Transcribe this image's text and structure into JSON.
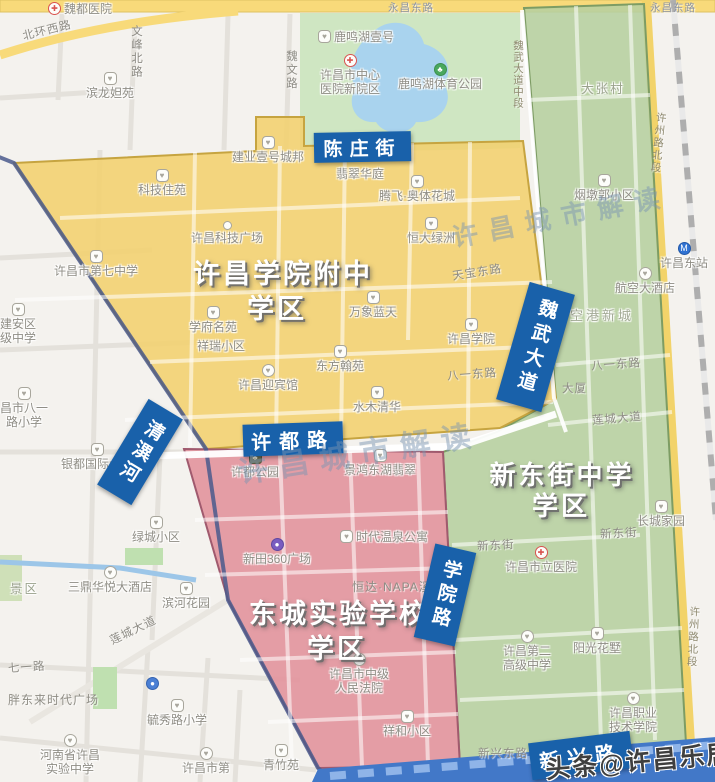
{
  "map_overlay": {
    "district_titles": {
      "yellow_1": "许昌学院附中",
      "yellow_2": "学区",
      "red_1": "东城实验学校",
      "red_2": "学区",
      "green_1": "新东街中学",
      "green_2": "学区"
    },
    "street_signs": {
      "chenzhuang": "陈庄街",
      "weiwu": "魏武大道",
      "xudu": "许都路",
      "qingyi": "清潩河",
      "xueyuan": "学院路",
      "xinxing": "新兴路"
    },
    "watermarks": {
      "city_1": "许昌城市解读",
      "city_2": "许昌城市解读",
      "credit": "头条@许昌乐居"
    }
  },
  "roads": {
    "yongchang_w": "永昌东路",
    "yongchang_e": "永昌东路",
    "beihuan_xi": "北环西路",
    "wenfeng_bei": "文峰北路",
    "weiwen": "魏文路",
    "weiwu_mid": "魏武大道中段",
    "tianbao_dong": "天宝东路",
    "bayi_dong_1": "八一东路",
    "bayi_dong_2": "八一东路",
    "liancheng_1": "莲城大道",
    "liancheng_2": "莲城大道",
    "qiyi": "七一路",
    "xindong_1": "新东街",
    "xindong_2": "新东街",
    "xuzhou_bei_1": "许州路北段",
    "xuzhou_bei_2": "许州路北段",
    "xinxing_dong": "新兴东路",
    "dasha_partial": "大厦"
  },
  "pois": {
    "weidu_hospital": "魏都医院",
    "binlong_yuan": "滨龙妲苑",
    "luminghu_yihao": "鹿鸣湖壹号",
    "central_hospital_1": "许昌市中心",
    "central_hospital_2": "医院新院区",
    "luminghu_park": "鹿鸣湖体育公园",
    "dazhang_village": "大张村",
    "jianye_city": "建业壹号城邦",
    "feicui_huating": "翡翠华庭",
    "keji_zhuyuan": "科技住苑",
    "tengfei_aoti": "腾飞·奥体花城",
    "hengda_lvzhou": "恒大绿洲",
    "keji_plaza": "许昌科技广场",
    "no7_middle_school": "许昌市第七中学",
    "jianan_1": "建安区",
    "jianan_2": "级中学",
    "xuefu_mingyuan": "学府名苑",
    "xiangrui_xiaoqu": "祥瑞小区",
    "wanxiang_lantian": "万象蓝天",
    "dongfang_hanyuan": "东方翰苑",
    "yingbinguan": "许昌迎宾馆",
    "xuchang_college": "许昌学院",
    "shuimu_qinghua": "水木清华",
    "bayi_primary_1": "昌市八一",
    "bayi_primary_2": "路小学",
    "yindu_tower": "银都国际大厦",
    "jingqu_partial": "景区",
    "xudu_park": "许都公园",
    "jinghong_feicui": "景鸿东湖翡翠",
    "shidai_wenquan": "时代温泉公寓",
    "xintian_360": "新田360广场",
    "hengda_napa": "恒达·NAPA溪",
    "zhongji_court_1": "许昌市中级",
    "zhongji_court_2": "人民法院",
    "xianghe_xiaoqu": "祥和小区",
    "lvcheng_xiaoqu": "绿城小区",
    "sanding_hotel": "三鼎华悦大酒店",
    "binhe_garden": "滨河花园",
    "pangdonglai": "胖东来时代广场",
    "yuxiu_primary": "毓秀路小学",
    "henan_shiyan_1": "河南省许昌",
    "henan_shiyan_2": "实验中学",
    "xuchang_di": "许昌市第",
    "qingzhu_yuan": "青竹苑",
    "yandunguo": "烟墩郭小区",
    "dongzhan": "许昌东站",
    "hangkong_hotel": "航空大酒店",
    "konggang": "空港新城",
    "changcheng_jiayuan": "长城家园",
    "shili_hospital": "许昌市立医院",
    "no2_senior_1": "许昌第二",
    "no2_senior_2": "高级中学",
    "yangguang_huashu": "阳光花墅",
    "zhiye_college_1": "许昌职业",
    "zhiye_college_2": "技术学院"
  }
}
